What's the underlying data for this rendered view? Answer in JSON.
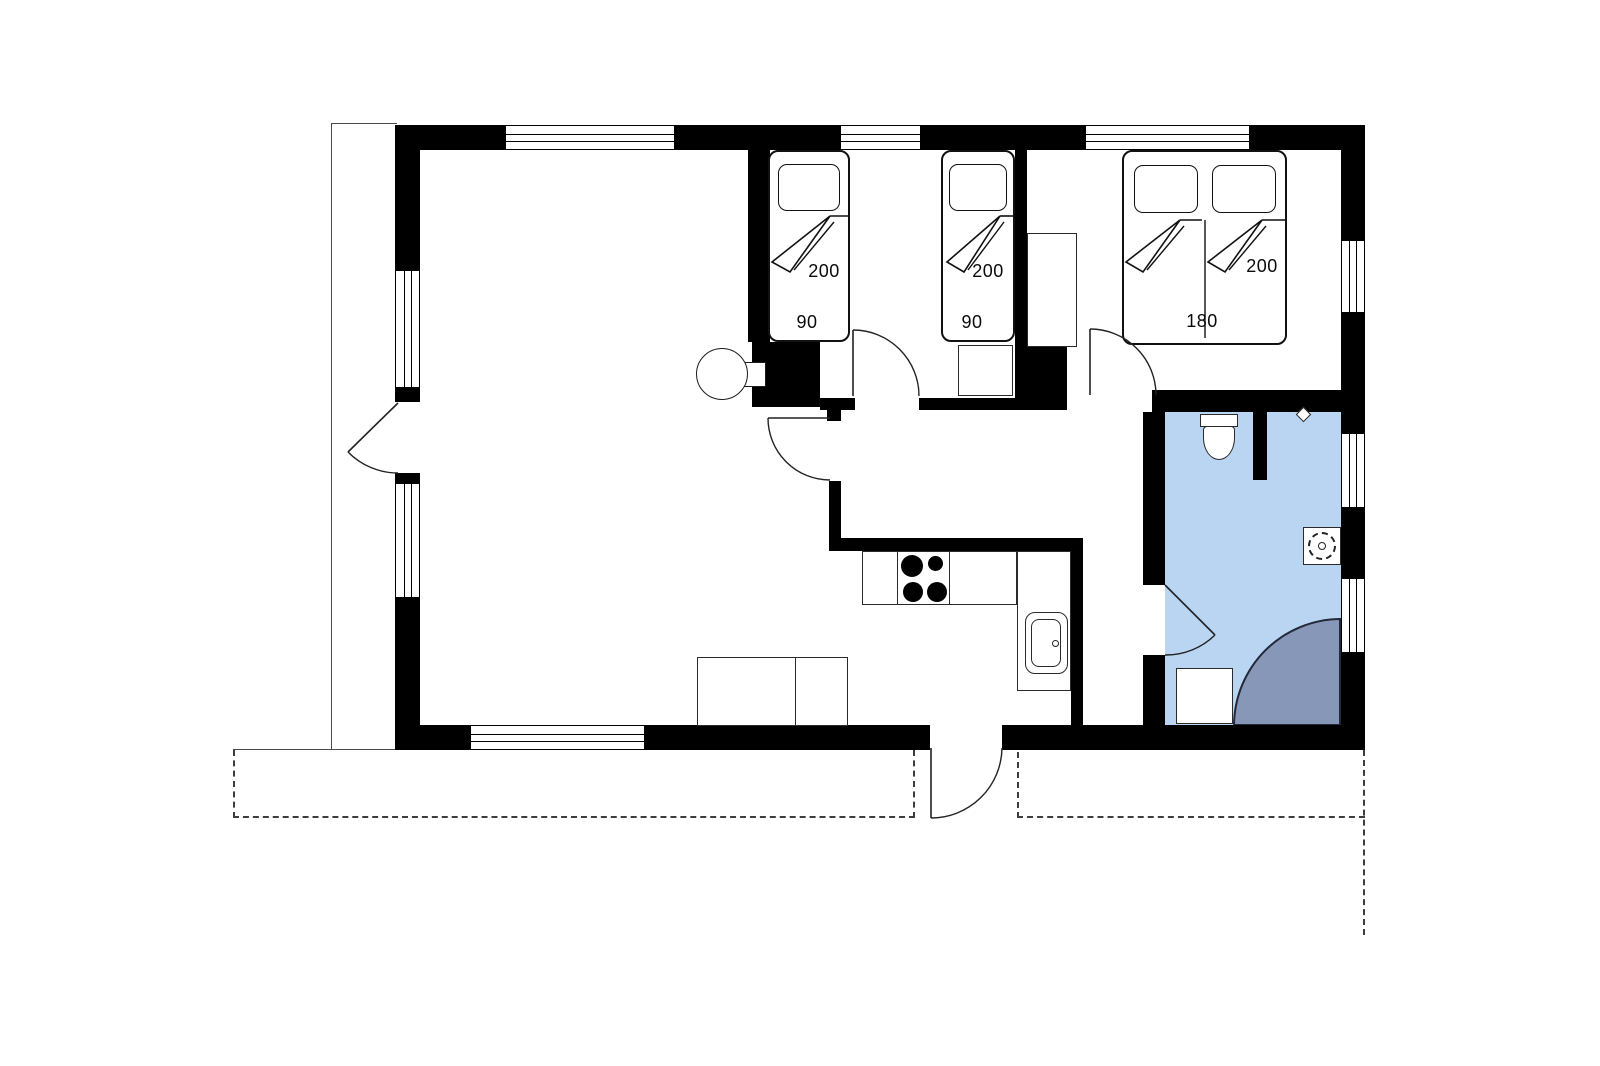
{
  "floor_plan": {
    "title": "summerhouse-floor-plan",
    "colors": {
      "wall": "#000000",
      "background": "#ffffff",
      "bathroom_floor": "#b9d5f2",
      "shower": "#8797b8",
      "outline": "#4a4a4a"
    },
    "beds": {
      "twin_bed_left": {
        "length_cm": "200",
        "width_cm": "90"
      },
      "twin_bed_right": {
        "length_cm": "200",
        "width_cm": "90"
      },
      "double_bed": {
        "length_cm": "200",
        "width_cm": "180"
      }
    }
  }
}
